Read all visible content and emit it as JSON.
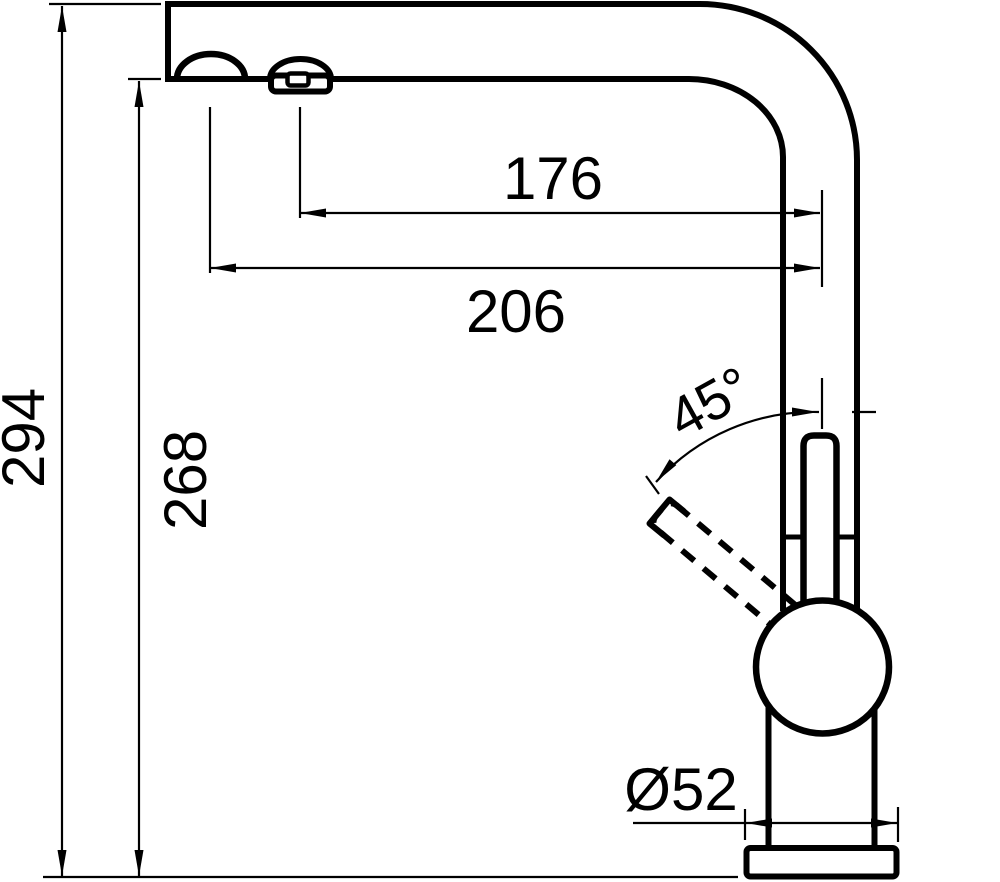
{
  "drawing": {
    "colors": {
      "line": "#000000",
      "background": "#ffffff"
    },
    "dimensions": {
      "overall_height": "294",
      "spout_underside_height": "268",
      "reach_inner": "176",
      "reach_outer": "206",
      "lever_angle": "45°",
      "base_diameter": "Ø52"
    }
  }
}
